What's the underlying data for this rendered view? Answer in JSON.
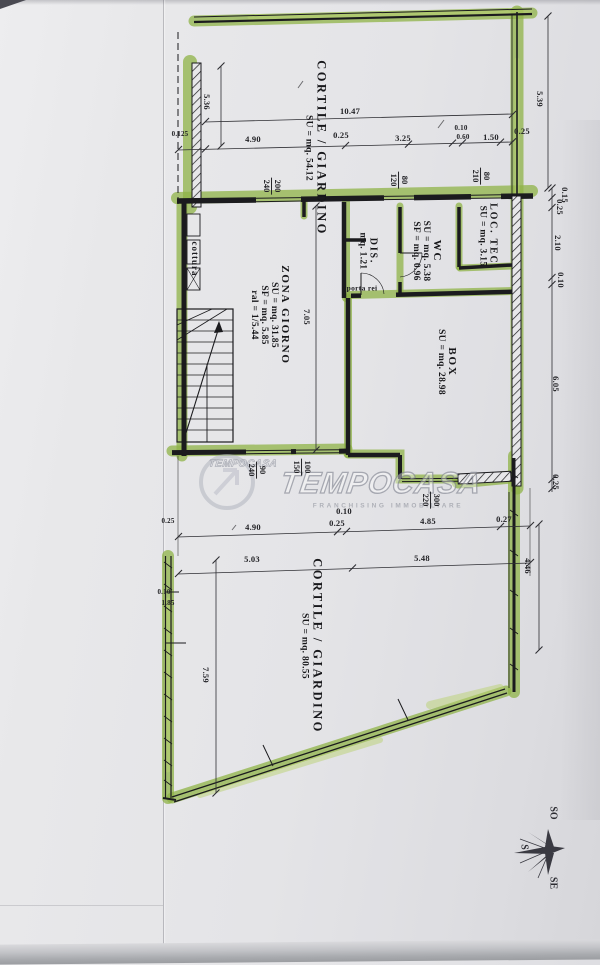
{
  "plan": {
    "rooms": {
      "cortile_top": {
        "name": "CORTILE / GIARDINO",
        "su": "SU = mq. 54.12"
      },
      "zona_giorno": {
        "name": "ZONA GIORNO",
        "su": "SU = mq. 31.85",
        "sf": "SF = mq. 5.85",
        "ratio": "ral = 1/5.44"
      },
      "dis": {
        "name": "DIS.",
        "area": "mq. 1.21"
      },
      "wc": {
        "name": "WC",
        "su": "SU = mq. 5.38",
        "sf": "SF = mq. 0.96"
      },
      "loc_tec": {
        "name": "LOC. TEC.",
        "su": "SU = mq. 3.15"
      },
      "box": {
        "name": "BOX",
        "su": "SU = mq. 28.98"
      },
      "cortile_bottom": {
        "name": "CORTILE / GIARDINO",
        "su": "SU = mq. 80.55"
      }
    },
    "annotations": {
      "cottura": "cottura",
      "porta": "porta rei"
    },
    "dims": {
      "t1": "10.47",
      "r2a": "0.125",
      "r2b": "4.90",
      "r2c": "0.25",
      "r2d": "3.25",
      "r2e": "0.10",
      "r2f": "0.60",
      "r2g": "1.50",
      "r2h": "0.25",
      "v_left": "5.36",
      "v_right": "5.39",
      "rc1": "0.15",
      "rc2": "0.25",
      "rc3": "2.10",
      "rc4": "0.10",
      "rc5": "6.05",
      "rc6": "0.25",
      "i1": "7.05",
      "m0": "0.25",
      "m1": "0.10",
      "m2": "0.25",
      "m3": "4.90",
      "m4": "4.85",
      "m5": "0.27",
      "m6": "5.03",
      "m7": "5.48",
      "m8": "4.46",
      "b1": "0.10",
      "b2": "1.85",
      "b3": "7.59"
    },
    "windows": {
      "w1": {
        "a": "200",
        "b": "240"
      },
      "w2": {
        "a": "80",
        "b": "120"
      },
      "w3": {
        "a": "80",
        "b": "210"
      },
      "w4": {
        "a": "90",
        "b": "240"
      },
      "w5": {
        "a": "100",
        "b": "150"
      },
      "w6": {
        "a": "300",
        "b": "220"
      }
    },
    "compass": {
      "so": "SO",
      "s": "S",
      "se": "SE"
    },
    "watermark": {
      "mini": "TEMPOCASA",
      "main": "TEMPOCASA",
      "sub": "FRANCHISING IMMOBILIARE"
    }
  }
}
